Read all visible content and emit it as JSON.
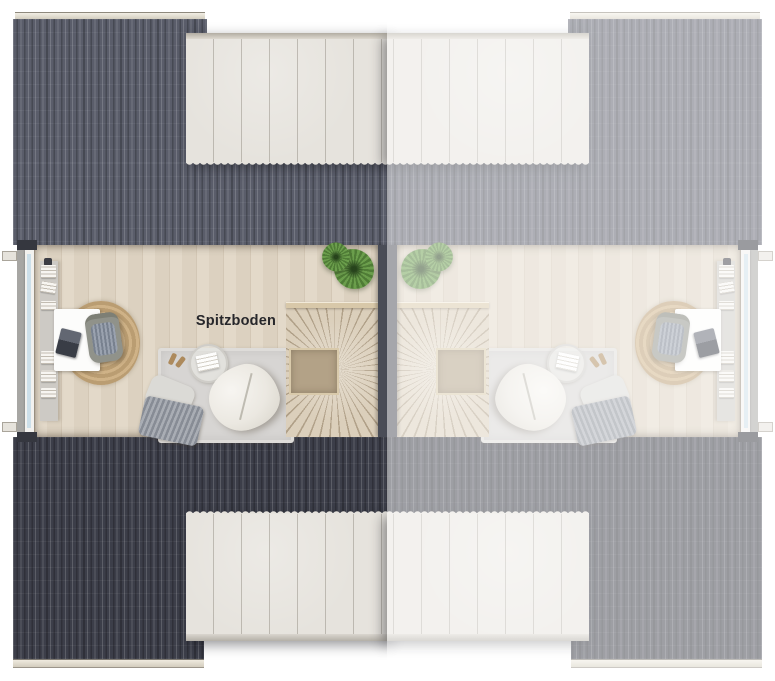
{
  "plan": {
    "room_label": "Spitzboden",
    "units": [
      {
        "id": "left-unit",
        "label": "Spitzboden",
        "state": "highlighted"
      },
      {
        "id": "right-unit",
        "label": "",
        "state": "faded-mirrored"
      }
    ],
    "furniture_icons": [
      "window-icon",
      "sideboard-icon",
      "books-icon",
      "desk-icon",
      "laptop-icon",
      "office-chair-icon",
      "jute-rug-icon",
      "area-rug-icon",
      "beanbag-icon",
      "side-table-icon",
      "magazine-icon",
      "slippers-icon",
      "pillow-icon",
      "blanket-icon",
      "fern-plant-icon",
      "winder-staircase-icon",
      "stair-landing-icon",
      "party-wall-icon",
      "roof-dormer-icon"
    ]
  },
  "colors": {
    "roof_top_dark": "#5a5d6a",
    "roof_bottom_dark": "#3c3e49",
    "dormer_panel": "#e6e3dd",
    "floor_wood": "#e1d7c6",
    "party_wall": "#4a4d57",
    "stair_wood": "#dbcfbb",
    "landing_wood": "#b3a287",
    "rug_gray": "#d7d5d3",
    "jute_tan": "#cfb287",
    "plant_green": "#6b9e4c",
    "glass_blue": "#ccdfe9",
    "label_text": "#27272b",
    "fade_overlay": "rgba(255,255,255,0.5)"
  }
}
